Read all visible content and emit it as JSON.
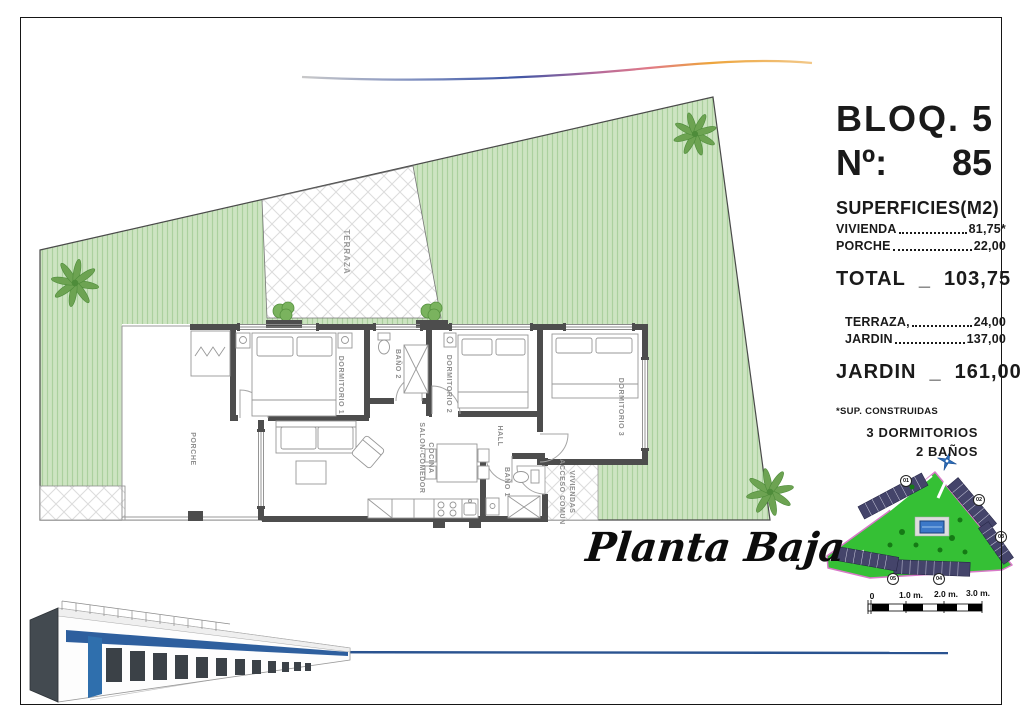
{
  "header": {
    "block": "BLOQ. 5",
    "unit_label": "Nº:",
    "unit_number": "85"
  },
  "surfaces": {
    "title": "SUPERFICIES(M2)",
    "rows": [
      {
        "label": "VIVIENDA",
        "value": "81,75*"
      },
      {
        "label": "PORCHE",
        "value": "22,00"
      }
    ],
    "total_label": "TOTAL",
    "total_sep": "_",
    "total_value": "103,75",
    "outdoor_rows": [
      {
        "label": "TERRAZA,",
        "value": "24,00"
      },
      {
        "label": "JARDIN",
        "value": "137,00"
      }
    ],
    "jardin_label": "JARDIN",
    "jardin_sep": "_",
    "jardin_value": "161,00",
    "footnote": "*SUP. CONSTRUIDAS",
    "feature1": "3 DORMITORIOS",
    "feature2": "2 BAÑOS"
  },
  "floorplan": {
    "caption": "Planta Baja",
    "rooms": {
      "terraza": "TERRAZA",
      "porche": "PORCHE",
      "dormitorio1": "DORMITORIO 1",
      "bano2": "BAÑO 2",
      "dormitorio2": "DORMITORIO 2",
      "dormitorio3": "DORMITORIO 3",
      "hall": "HALL",
      "bano1": "BAÑO 1",
      "salon_line1": "SALON-COMEDOR",
      "salon_line2": "COCINA",
      "acceso_line1": "ACCESO COMUN",
      "acceso_line2": "VIVIENDAS"
    }
  },
  "site_map": {
    "blocks": [
      "01",
      "02",
      "03",
      "04",
      "05"
    ],
    "scale_labels": [
      "0",
      "1.0 m.",
      "2.0 m.",
      "3.0 m."
    ]
  },
  "colors": {
    "garden_green": "#cde4c2",
    "garden_stripe": "#abd09e",
    "wall_grey": "#4d4d4d",
    "label_grey": "#8f8f8f",
    "map_green": "#35c035",
    "map_outline_pink": "#d879c8",
    "pool_blue": "#3c78c8",
    "swoosh_blue": "#3d55a5",
    "swoosh_orange": "#eda43b",
    "render_line_blue": "#2a5390"
  }
}
